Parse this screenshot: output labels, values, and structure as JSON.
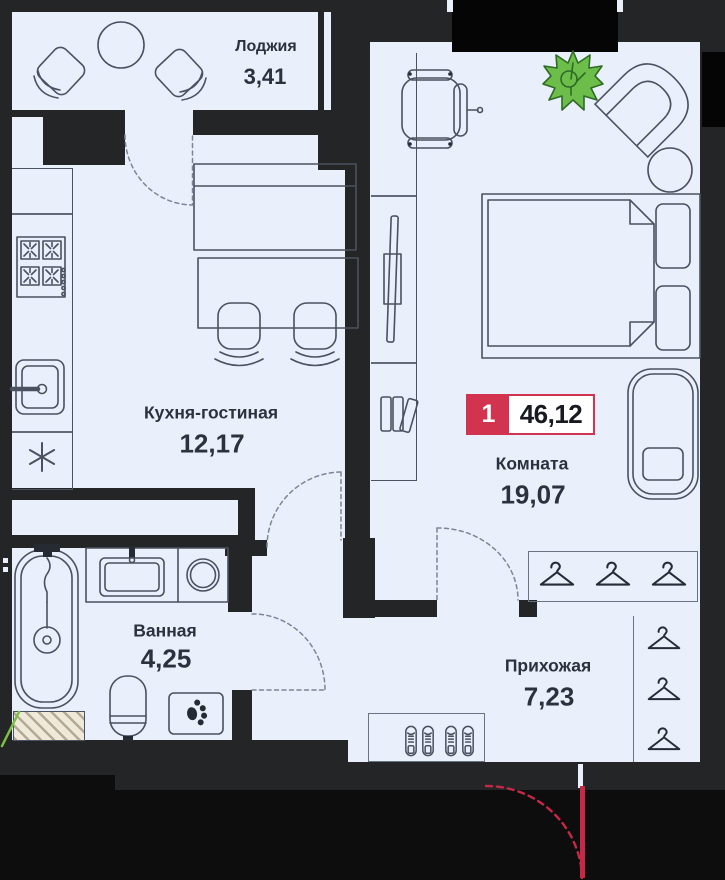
{
  "plan": {
    "badge": {
      "room_count": "1",
      "total_area": "46,12"
    },
    "rooms": [
      {
        "key": "loggia",
        "name": "Лоджия",
        "area": "3,41"
      },
      {
        "key": "kitchen_living",
        "name": "Кухня-гостиная",
        "area": "12,17"
      },
      {
        "key": "room",
        "name": "Комната",
        "area": "19,07"
      },
      {
        "key": "bathroom",
        "name": "Ванная",
        "area": "4,25"
      },
      {
        "key": "hallway",
        "name": "Прихожая",
        "area": "7,23"
      }
    ],
    "colors": {
      "accent_red": "#d23450",
      "entrance_red": "#c62846",
      "plant_green": "#6dbd4a",
      "floor": "#e9effb",
      "wall": "#232527",
      "window_block": "#050506",
      "outside": "#0d0d0e",
      "line": "#4a5160",
      "text": "#2c323c"
    },
    "icons": [
      "plant-icon",
      "hanger-icon",
      "shoe-icon",
      "paw-icon",
      "stove-burner-icon",
      "fridge-snowflake-icon",
      "sink-icon",
      "bathtub-icon",
      "toilet-icon",
      "washing-machine-icon",
      "bookshelf-icon",
      "monitor-icon",
      "door-swing-icon",
      "entrance-door-icon"
    ]
  }
}
